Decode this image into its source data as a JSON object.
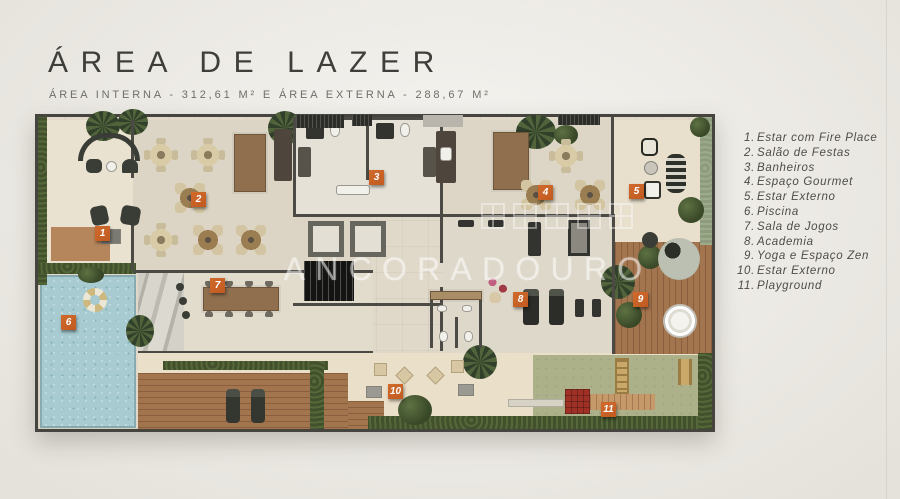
{
  "page": {
    "title": "ÁREA DE LAZER",
    "subtitle": "ÁREA INTERNA - 312,61 M² E ÁREA EXTERNA - 288,67 M²"
  },
  "watermark": {
    "text": "ANCORADOURO"
  },
  "legend": {
    "items": [
      {
        "num": "1.",
        "label": "Estar com Fire Place"
      },
      {
        "num": "2.",
        "label": "Salão de Festas"
      },
      {
        "num": "3.",
        "label": "Banheiros"
      },
      {
        "num": "4.",
        "label": "Espaço Gourmet"
      },
      {
        "num": "5.",
        "label": "Estar Externo"
      },
      {
        "num": "6.",
        "label": "Piscina"
      },
      {
        "num": "7.",
        "label": "Sala de Jogos"
      },
      {
        "num": "8.",
        "label": "Academia"
      },
      {
        "num": "9.",
        "label": "Yoga e Espaço Zen"
      },
      {
        "num": "10.",
        "label": "Estar Externo"
      },
      {
        "num": "11.",
        "label": "Playground"
      }
    ]
  },
  "markers": [
    {
      "num": "1"
    },
    {
      "num": "2"
    },
    {
      "num": "3"
    },
    {
      "num": "4"
    },
    {
      "num": "5"
    },
    {
      "num": "6"
    },
    {
      "num": "7"
    },
    {
      "num": "8"
    },
    {
      "num": "9"
    },
    {
      "num": "10"
    },
    {
      "num": "11"
    }
  ],
  "colors": {
    "background": "#eeebe4",
    "plan_floor": "#e0d9ca",
    "accent_marker": "#c05a20",
    "pool": "#a7cbd1",
    "hedge_dark": "#42502c",
    "hedge_sage": "#8e9c7d",
    "deck_wood": "#a3754f",
    "lawn": "#acb189",
    "wall": "#4b4a44",
    "title_text": "#3e3e3a"
  }
}
